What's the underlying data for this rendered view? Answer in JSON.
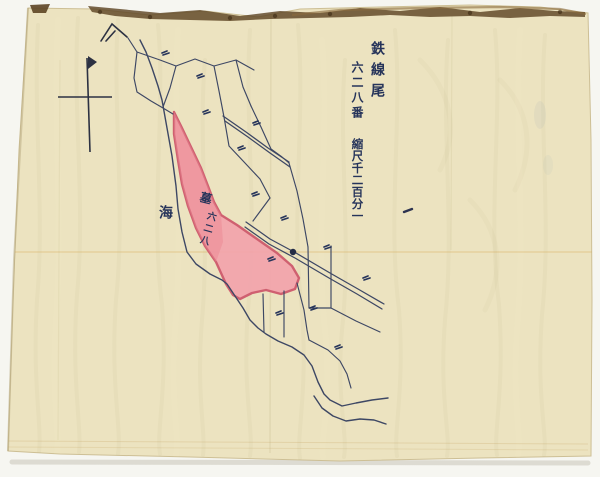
{
  "labels": [
    {
      "name": "place-name-label",
      "text": "鉄線尾",
      "x": 370,
      "y": 41,
      "size": 14,
      "spacing": 7,
      "rotate": 0
    },
    {
      "name": "parcel-number-title-label",
      "text": "六二八番",
      "x": 351,
      "y": 61,
      "size": 12,
      "spacing": 3,
      "rotate": 0
    },
    {
      "name": "scale-note-label",
      "text": "縮尺千二百分一",
      "x": 351,
      "y": 138,
      "size": 11.5,
      "spacing": 0.5,
      "rotate": 0
    },
    {
      "name": "sea-label",
      "text": "海",
      "x": 158,
      "y": 205,
      "size": 14,
      "spacing": 0,
      "rotate": 0
    },
    {
      "name": "parcel-grave-label",
      "text": "墓",
      "x": 201,
      "y": 192,
      "size": 12,
      "spacing": 0,
      "rotate": 14
    },
    {
      "name": "parcel-628-label",
      "text": "六二八",
      "x": 207,
      "y": 211,
      "size": 9.5,
      "spacing": 3,
      "rotate": 16
    }
  ],
  "colors": {
    "scan_bg": "#f6f6f1",
    "paper": "#ece3c0",
    "paper_edge": "#cdbf95",
    "torn_edge": "#5e4524",
    "torn_light": "#8a6b3e",
    "ink_line": "#3d4764",
    "ink_text": "#26345a",
    "pink_fill": "#f2a3ab",
    "pink_deep": "#eb8793",
    "pink_stroke": "#cf6070",
    "shadow": "#c9c5b8"
  },
  "geometry": {
    "paper_outline": [
      [
        28,
        8
      ],
      [
        95,
        9
      ],
      [
        150,
        15
      ],
      [
        205,
        11
      ],
      [
        258,
        17
      ],
      [
        300,
        9
      ],
      [
        380,
        7
      ],
      [
        470,
        5
      ],
      [
        540,
        7
      ],
      [
        588,
        13
      ],
      [
        591,
        140
      ],
      [
        592,
        300
      ],
      [
        591,
        456
      ],
      [
        480,
        458
      ],
      [
        340,
        461
      ],
      [
        190,
        457
      ],
      [
        60,
        454
      ],
      [
        8,
        451
      ],
      [
        13,
        300
      ],
      [
        19,
        150
      ]
    ],
    "torn_strip": [
      [
        88,
        6
      ],
      [
        120,
        9
      ],
      [
        160,
        13
      ],
      [
        200,
        10
      ],
      [
        240,
        16
      ],
      [
        280,
        11
      ],
      [
        320,
        13
      ],
      [
        360,
        8
      ],
      [
        400,
        11
      ],
      [
        440,
        7
      ],
      [
        480,
        12
      ],
      [
        520,
        8
      ],
      [
        555,
        11
      ],
      [
        585,
        12
      ],
      [
        585,
        17
      ],
      [
        550,
        16
      ],
      [
        510,
        18
      ],
      [
        470,
        16
      ],
      [
        430,
        17
      ],
      [
        390,
        15
      ],
      [
        350,
        17
      ],
      [
        310,
        18
      ],
      [
        270,
        19
      ],
      [
        230,
        21
      ],
      [
        190,
        20
      ],
      [
        150,
        19
      ],
      [
        115,
        16
      ],
      [
        92,
        12
      ]
    ],
    "torn_dots": [
      [
        100,
        12
      ],
      [
        150,
        17
      ],
      [
        230,
        18
      ],
      [
        275,
        16
      ],
      [
        330,
        14
      ],
      [
        470,
        13
      ],
      [
        560,
        12
      ]
    ],
    "corner_tear": [
      [
        30,
        5
      ],
      [
        50,
        4
      ],
      [
        46,
        13
      ],
      [
        33,
        13
      ]
    ],
    "creases": [
      {
        "p": [
          [
            6,
            252
          ],
          [
            592,
            252
          ]
        ],
        "c": "#d7a44e",
        "w": 1.5,
        "o": 0.3
      },
      {
        "p": [
          [
            271,
            12
          ],
          [
            270,
            453
          ]
        ],
        "c": "#a89a66",
        "w": 1.5,
        "o": 0.16
      },
      {
        "p": [
          [
            452,
            16
          ],
          [
            451,
            250
          ]
        ],
        "c": "#a89a66",
        "w": 1.2,
        "o": 0.12
      },
      {
        "p": [
          [
            60,
            60
          ],
          [
            58,
            440
          ]
        ],
        "c": "#a89a66",
        "w": 1.2,
        "o": 0.1
      },
      {
        "p": [
          [
            8,
            441
          ],
          [
            588,
            444
          ]
        ],
        "c": "#c2a05c",
        "w": 1,
        "o": 0.25
      },
      {
        "p": [
          [
            8,
            447
          ],
          [
            588,
            450
          ]
        ],
        "c": "#c2a05c",
        "w": 1,
        "o": 0.2
      }
    ],
    "pink": [
      [
        174,
        112
      ],
      [
        181,
        126
      ],
      [
        191,
        147
      ],
      [
        201,
        168
      ],
      [
        208,
        186
      ],
      [
        214,
        202
      ],
      [
        221,
        215
      ],
      [
        237,
        225
      ],
      [
        257,
        239
      ],
      [
        277,
        253
      ],
      [
        292,
        266
      ],
      [
        299,
        278
      ],
      [
        295,
        289
      ],
      [
        281,
        294
      ],
      [
        266,
        290
      ],
      [
        252,
        293
      ],
      [
        240,
        299
      ],
      [
        233,
        295
      ],
      [
        226,
        284
      ],
      [
        216,
        262
      ],
      [
        205,
        246
      ],
      [
        196,
        228
      ],
      [
        188,
        206
      ],
      [
        182,
        184
      ],
      [
        178,
        160
      ],
      [
        174,
        134
      ]
    ],
    "pink_overlay": [
      [
        174,
        112
      ],
      [
        181,
        126
      ],
      [
        191,
        147
      ],
      [
        201,
        168
      ],
      [
        208,
        186
      ],
      [
        214,
        202
      ],
      [
        221,
        215
      ],
      [
        223,
        242
      ],
      [
        216,
        262
      ],
      [
        205,
        246
      ],
      [
        196,
        228
      ],
      [
        188,
        206
      ],
      [
        182,
        184
      ],
      [
        178,
        160
      ],
      [
        174,
        134
      ]
    ],
    "shore_lines": [
      [
        [
          140,
          40
        ],
        [
          146,
          52
        ],
        [
          152,
          68
        ],
        [
          158,
          86
        ],
        [
          162,
          100
        ],
        [
          167,
          128
        ],
        [
          172,
          156
        ],
        [
          176,
          186
        ],
        [
          178,
          209
        ],
        [
          182,
          232
        ],
        [
          187,
          252
        ],
        [
          196,
          264
        ],
        [
          210,
          274
        ],
        [
          222,
          280
        ],
        [
          227,
          284
        ],
        [
          235,
          296
        ],
        [
          243,
          308
        ],
        [
          250,
          320
        ],
        [
          258,
          328
        ],
        [
          266,
          334
        ],
        [
          278,
          341
        ],
        [
          292,
          347
        ],
        [
          304,
          355
        ],
        [
          312,
          366
        ],
        [
          318,
          382
        ],
        [
          324,
          394
        ],
        [
          330,
          400
        ],
        [
          342,
          406
        ],
        [
          356,
          403
        ],
        [
          372,
          400
        ],
        [
          388,
          398
        ]
      ],
      [
        [
          314,
          396
        ],
        [
          322,
          408
        ],
        [
          333,
          416
        ],
        [
          346,
          421
        ],
        [
          360,
          419
        ],
        [
          374,
          420
        ],
        [
          386,
          424
        ]
      ]
    ],
    "parcel_lines": [
      [
        [
          128,
          38
        ],
        [
          137,
          52
        ],
        [
          134,
          78
        ],
        [
          137,
          92
        ],
        [
          151,
          101
        ],
        [
          163,
          108
        ],
        [
          173,
          114
        ]
      ],
      [
        [
          137,
          52
        ],
        [
          160,
          60
        ],
        [
          176,
          66
        ]
      ],
      [
        [
          176,
          66
        ],
        [
          170,
          88
        ],
        [
          163,
          107
        ]
      ],
      [
        [
          176,
          66
        ],
        [
          195,
          59
        ],
        [
          214,
          66
        ],
        [
          236,
          60
        ],
        [
          254,
          70
        ]
      ],
      [
        [
          214,
          66
        ],
        [
          219,
          91
        ],
        [
          224,
          117
        ]
      ],
      [
        [
          236,
          60
        ],
        [
          243,
          87
        ],
        [
          251,
          106
        ]
      ],
      [
        [
          251,
          106
        ],
        [
          261,
          127
        ],
        [
          271,
          149
        ],
        [
          282,
          157
        ],
        [
          289,
          163
        ]
      ],
      [
        [
          224,
          117
        ],
        [
          229,
          146
        ],
        [
          245,
          163
        ],
        [
          260,
          179
        ],
        [
          270,
          198
        ]
      ],
      [
        [
          270,
          198
        ],
        [
          253,
          221
        ]
      ],
      [
        [
          289,
          163
        ],
        [
          297,
          191
        ],
        [
          303,
          219
        ],
        [
          308,
          247
        ]
      ],
      [
        [
          308,
          247
        ],
        [
          309,
          308
        ]
      ],
      [
        [
          331,
          246
        ],
        [
          331,
          308
        ]
      ],
      [
        [
          309,
          308
        ],
        [
          331,
          308
        ]
      ],
      [
        [
          331,
          308
        ],
        [
          356,
          321
        ],
        [
          380,
          332
        ]
      ],
      [
        [
          263,
          294
        ],
        [
          264,
          332
        ]
      ],
      [
        [
          284,
          291
        ],
        [
          284,
          337
        ]
      ],
      [
        [
          297,
          283
        ],
        [
          304,
          310
        ],
        [
          307,
          330
        ],
        [
          309,
          340
        ]
      ],
      [
        [
          309,
          340
        ],
        [
          328,
          350
        ],
        [
          340,
          361
        ],
        [
          347,
          374
        ],
        [
          351,
          388
        ]
      ]
    ],
    "roads": [
      [
        [
          223,
          116
        ],
        [
          246,
          132
        ],
        [
          268,
          148
        ],
        [
          289,
          162
        ]
      ],
      [
        [
          225,
          121
        ],
        [
          248,
          137
        ],
        [
          270,
          153
        ],
        [
          290,
          167
        ]
      ],
      [
        [
          246,
          222
        ],
        [
          270,
          239
        ],
        [
          296,
          253
        ],
        [
          330,
          273
        ],
        [
          358,
          289
        ],
        [
          384,
          304
        ]
      ],
      [
        [
          245,
          227
        ],
        [
          269,
          244
        ],
        [
          295,
          258
        ],
        [
          329,
          278
        ],
        [
          357,
          294
        ],
        [
          382,
          309
        ]
      ]
    ],
    "scribbles": [
      [
        162,
        53
      ],
      [
        197,
        76
      ],
      [
        203,
        112
      ],
      [
        253,
        123
      ],
      [
        238,
        148
      ],
      [
        252,
        194
      ],
      [
        281,
        218
      ],
      [
        324,
        247
      ],
      [
        363,
        278
      ],
      [
        310,
        308
      ],
      [
        276,
        313
      ],
      [
        335,
        347
      ],
      [
        268,
        259
      ]
    ],
    "compass": {
      "pole": [
        [
          87,
          58
        ],
        [
          90,
          152
        ]
      ],
      "bar": [
        [
          58,
          97
        ],
        [
          112,
          97
        ]
      ],
      "flag": [
        [
          88,
          56
        ],
        [
          97,
          62
        ],
        [
          88,
          69
        ]
      ]
    },
    "corner_mark": [
      [
        [
          101,
          41
        ],
        [
          112,
          24
        ],
        [
          127,
          37
        ]
      ],
      [
        [
          106,
          41
        ],
        [
          115,
          31
        ]
      ]
    ],
    "junction_dot": [
      293,
      252
    ],
    "ink_dash": [
      404,
      212,
      412,
      209
    ],
    "smudges": [
      {
        "x": 540,
        "y": 115,
        "rx": 6,
        "ry": 14,
        "o": 0.1
      },
      {
        "x": 548,
        "y": 165,
        "rx": 5,
        "ry": 10,
        "o": 0.08
      }
    ]
  }
}
